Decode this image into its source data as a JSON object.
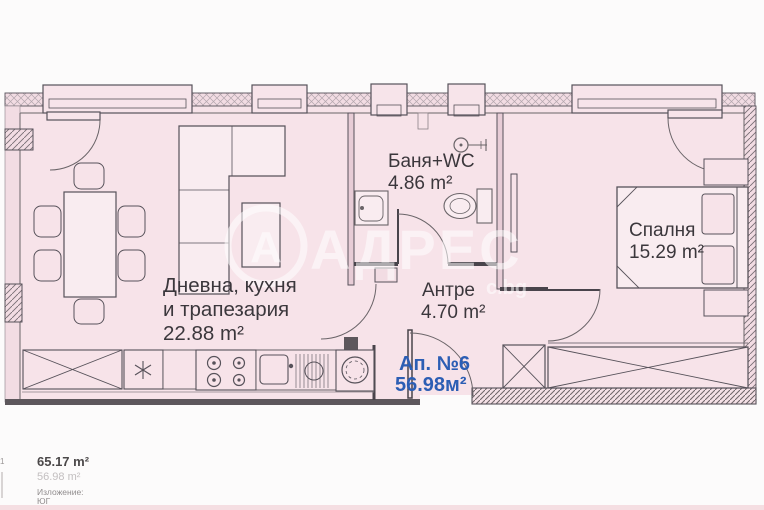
{
  "plan": {
    "rooms": {
      "living": {
        "name_line1": "Дневна, кухня",
        "name_line2": "и трапезария",
        "area": "22.88 m²"
      },
      "bathroom": {
        "name": "Баня+WC",
        "area": "4.86 m²"
      },
      "hallway": {
        "name": "Антре",
        "area": "4.70 m²"
      },
      "bedroom": {
        "name": "Спалня",
        "area": "15.29 m²"
      }
    },
    "apartment": {
      "label": "Ап. №6",
      "area": "56.98м²",
      "color": "#2c5eb4"
    }
  },
  "watermark": {
    "logo_letter": "А",
    "brand": "АДРЕС",
    "suffix": "с.bg"
  },
  "footer": {
    "total_area": "65.17 m²",
    "net_area": "56.98 m²",
    "exposure_label": "Изложение:",
    "exposure_value": "ЮГ"
  },
  "edge_fragment": {
    "label": "х1"
  },
  "colors": {
    "accent_blue": "#2c5eb4",
    "plan_pink": "#f7e3e9",
    "wall_dark": "#49444b",
    "bottom_strip": "#f5dee2"
  }
}
